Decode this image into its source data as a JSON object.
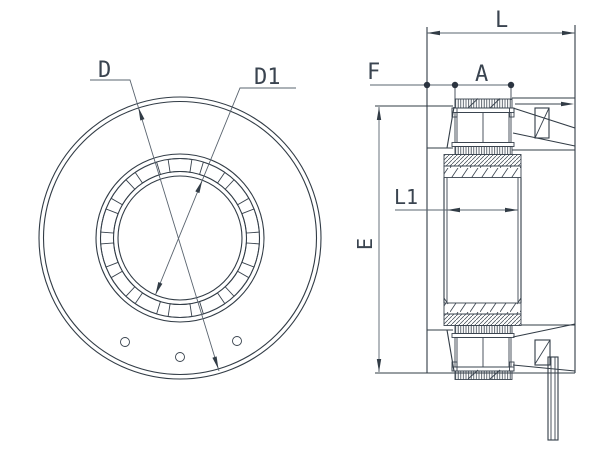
{
  "drawing": {
    "kind": "bearing-unit-technical-drawing",
    "labels": {
      "D": "D",
      "D1": "D1",
      "L": "L",
      "F": "F",
      "A": "A",
      "L1": "L1",
      "E": "E"
    },
    "colors": {
      "background": "#ffffff",
      "part_line": "#323c46",
      "dimension_line": "#5a646f",
      "text": "#3a4450"
    }
  }
}
